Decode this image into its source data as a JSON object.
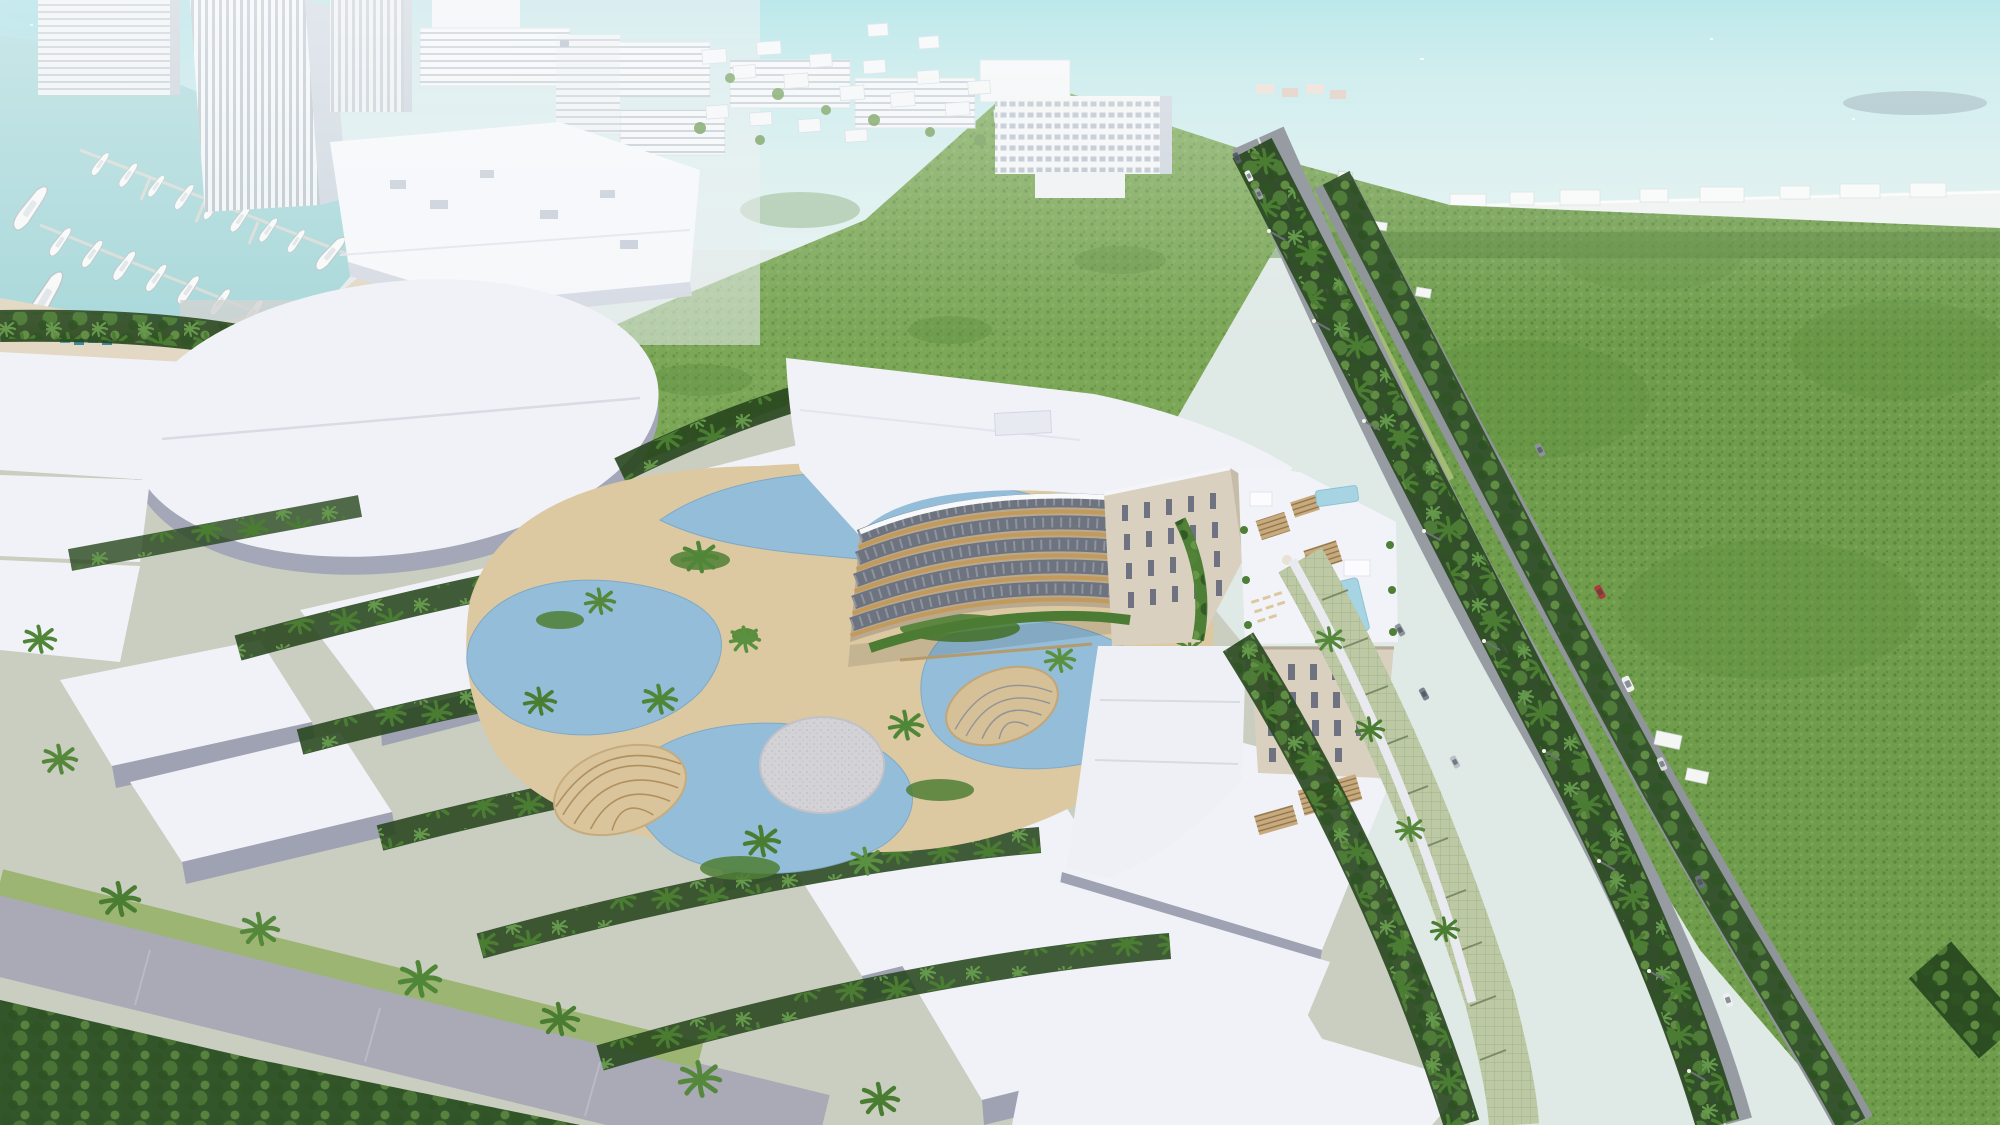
{
  "scene": {
    "title": "Aerial rendering of beachfront resort masterplan",
    "view": "high-angle aerial, daytime",
    "description": "Rendered resort site with lagoon pools, white massing volumes and palm rows in foreground; curved gold-banded condo building with rooftop pools; marina with yachts and white towers top-left; vast green mangrove field and tree-lined boulevard with traffic on the right; hazy turquoise ocean at the horizon."
  },
  "palette": {
    "ocean_near": "#8fd8de",
    "ocean_far": "#e2f1f0",
    "marina_water": "#a9d8da",
    "beach_strip": "#eef2f1",
    "city_white": "#f2f5f7",
    "city_shadow": "#c9d2da",
    "field_green": "#7ba757",
    "mangrove_green": "#6f9d4b",
    "palm_green": "#4f8637",
    "canopy_dark": "#2c5020",
    "roof_white": "#f1f2f8",
    "wall_gray": "#9fa2b2",
    "pool_blue": "#93bdd8",
    "rooftop_pool_blue": "#a6d4e2",
    "sand_path": "#dcc9a2",
    "pebble_gray": "#d3d2d6",
    "facade_gold": "#c29a5c",
    "facade_window": "#6e7380",
    "stone_beige": "#d9d0bf",
    "asphalt": "#969ca1",
    "asphalt_far": "#8f9599",
    "access_road": "#a9aab6",
    "hedge_dark": "#33552a",
    "grass_paver": "#bcc9a4",
    "construction_sand": "#e2d8c4",
    "boat_white": "#f7f9f9",
    "pergola_wood": "#c9aa7c"
  },
  "marina": {
    "boat_count": 19,
    "large_yachts": 3
  },
  "boulevard": {
    "street_light_count": 9,
    "lane_marking": "dashed white",
    "road_cars": [
      "#5a6068",
      "#eef0f1",
      "#9aa1a8",
      "#8d949b",
      "#b03a3a",
      "#eef0f1",
      "#d8dbde",
      "#6a7178",
      "#eef0f1"
    ]
  },
  "parking": {
    "parked_cars": [
      "#8d949b",
      "#7a838c",
      "#b9bfc4"
    ]
  },
  "construction_lot": {
    "parked_cars": [
      "#f2f4f4",
      "#f2f4f4"
    ],
    "billboard_count": 8
  },
  "resort": {
    "building_floors": 5,
    "rooftop_pools": 2,
    "lagoon_pools": 5,
    "shade_domes": 2,
    "white_volumes": 14
  }
}
